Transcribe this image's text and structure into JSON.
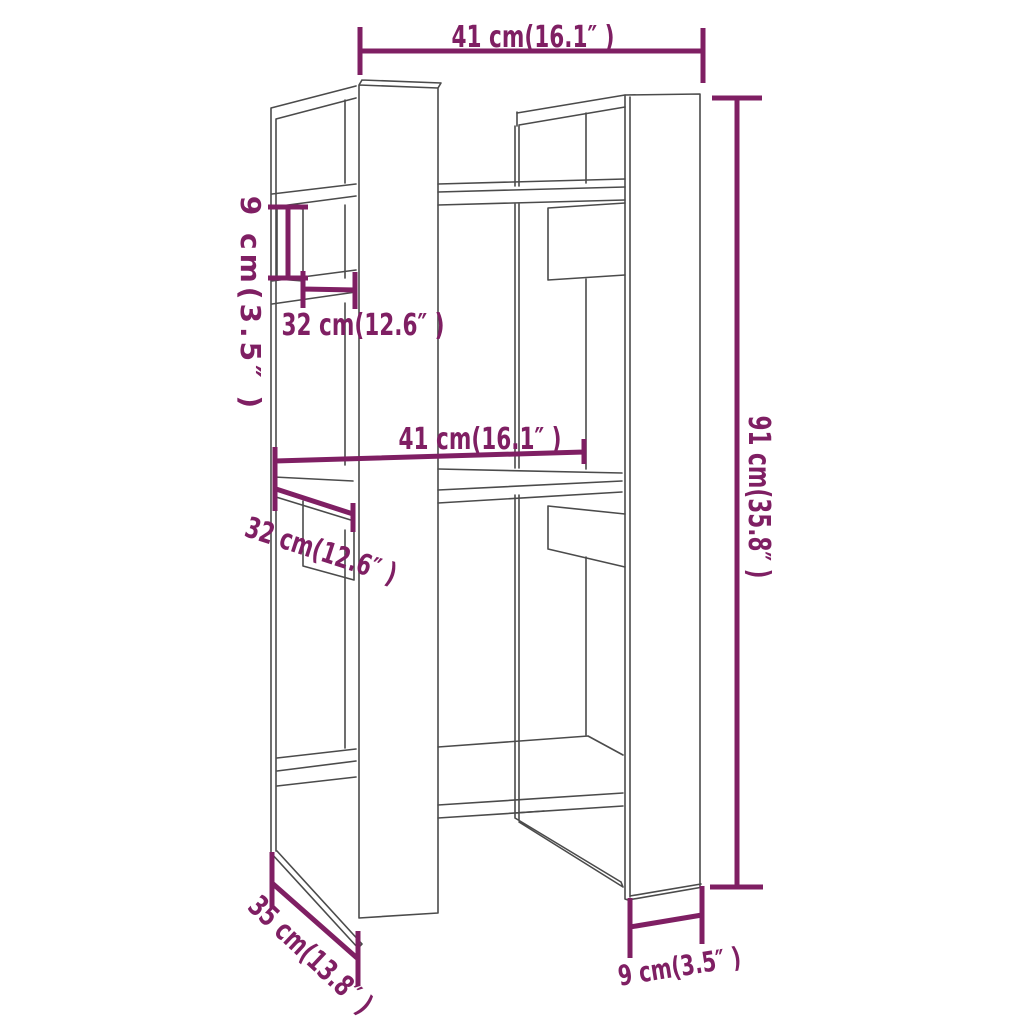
{
  "diagram": {
    "type": "furniture-dimension-diagram",
    "background": "#ffffff",
    "colors": {
      "dimension": "#7f1f63",
      "outline": "#4b4b4b"
    },
    "dimensions": [
      {
        "id": "top-width",
        "label": "41 cm(16.1″ )",
        "cm": 41,
        "inch": 16.1
      },
      {
        "id": "upper-shelf-height",
        "label": "9 cm(3.5″ )",
        "cm": 9,
        "inch": 3.5
      },
      {
        "id": "upper-shelf-width",
        "label": "32 cm(12.6″ )",
        "cm": 32,
        "inch": 12.6
      },
      {
        "id": "middle-width",
        "label": "41 cm(16.1″ )",
        "cm": 41,
        "inch": 16.1
      },
      {
        "id": "middle-shelf-width",
        "label": "32 cm(12.6″ )",
        "cm": 32,
        "inch": 12.6
      },
      {
        "id": "overall-height",
        "label": "91 cm(35.8″ )",
        "cm": 91,
        "inch": 35.8
      },
      {
        "id": "depth",
        "label": "35 cm(13.8″ )",
        "cm": 35,
        "inch": 13.8
      },
      {
        "id": "base-panel-width",
        "label": "9 cm(3.5″ )",
        "cm": 9,
        "inch": 3.5
      }
    ]
  }
}
